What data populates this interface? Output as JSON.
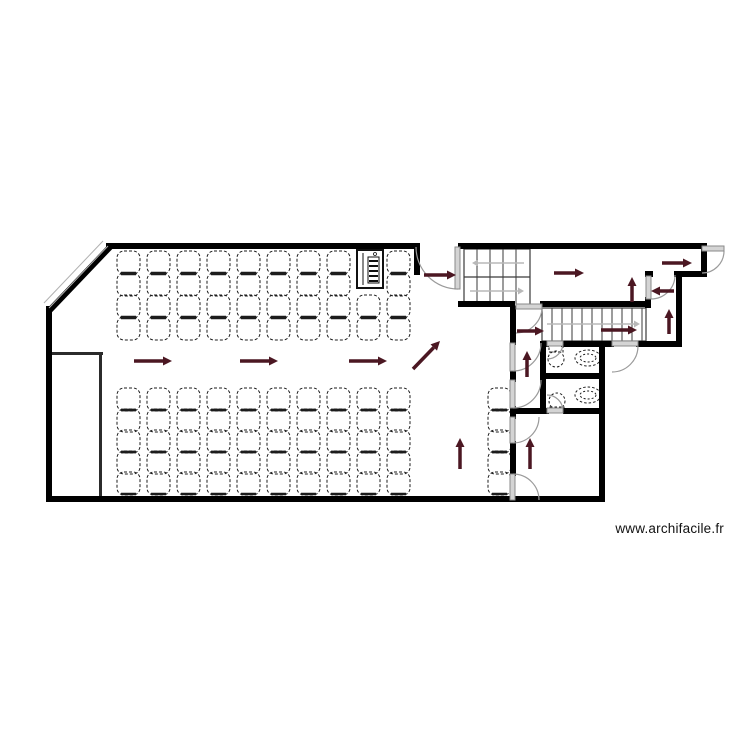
{
  "page": {
    "background": "#ffffff",
    "width": 750,
    "height": 750,
    "watermark": "www.archifacile.fr"
  },
  "colors": {
    "wall": "#000000",
    "inner_wall": "#2b2b2b",
    "arrow": "#4b1722",
    "door_leaf": "#d4d4d4",
    "door_leaf_stroke": "#8a8a8a",
    "door_arc": "#9a9a9a",
    "stair": "#3a3a3a",
    "stair_arrow": "#b8b8b8",
    "chair": "#1c1c1c",
    "fixture": "#1c1c1c",
    "window": "#b0b0b0",
    "panel": "#111111"
  },
  "plan": {
    "walls": [
      [
        106,
        243,
        313,
        6
      ],
      [
        458,
        243,
        249,
        6
      ],
      [
        701,
        243,
        6,
        34
      ],
      [
        674,
        271,
        33,
        6
      ],
      [
        645,
        271,
        8,
        6
      ],
      [
        645,
        297,
        6,
        11
      ],
      [
        676,
        271,
        6,
        76
      ],
      [
        601,
        341,
        13,
        6
      ],
      [
        636,
        341,
        46,
        6
      ],
      [
        599,
        341,
        6,
        161
      ],
      [
        46,
        496,
        559,
        6
      ],
      [
        46,
        306,
        6,
        196
      ],
      [
        414,
        243,
        6,
        32
      ],
      [
        458,
        301,
        57,
        6
      ],
      [
        540,
        301,
        110,
        6
      ],
      [
        510,
        306,
        6,
        39
      ],
      [
        510,
        371,
        6,
        11
      ],
      [
        510,
        406,
        6,
        13
      ],
      [
        510,
        441,
        6,
        35
      ],
      [
        540,
        341,
        6,
        73
      ],
      [
        540,
        341,
        9,
        6
      ],
      [
        561,
        341,
        42,
        6
      ],
      [
        540,
        373,
        63,
        6
      ],
      [
        510,
        408,
        39,
        6
      ],
      [
        563,
        408,
        40,
        6
      ]
    ],
    "inner_walls": [
      [
        46,
        352,
        57,
        3
      ],
      [
        99,
        352,
        3,
        147
      ]
    ],
    "diagonal_wall": {
      "x1": 48,
      "y1": 312,
      "x2": 111,
      "y2": 246,
      "w": 6
    },
    "window_lines": [
      [
        44,
        303,
        103,
        241
      ],
      [
        49,
        308,
        108,
        246
      ]
    ],
    "doors": [
      {
        "leaf": [
          455,
          247,
          5,
          42
        ],
        "arc": "M 458 289 A 42 42 0 0 1 416 247"
      },
      {
        "leaf": [
          702,
          246,
          22,
          5
        ],
        "arc": "M 724 251 A 22 22 0 0 1 702 273"
      },
      {
        "leaf": [
          646,
          276,
          5,
          23
        ],
        "arc": "M 651 299 A 24 24 0 0 0 675 275"
      },
      {
        "leaf": [
          516,
          304,
          26,
          5
        ],
        "arc": "M 542 307 A 26 26 0 0 1 516 333"
      },
      {
        "leaf": [
          510,
          343,
          5,
          28
        ],
        "arc": "M 513 371 A 28 28 0 0 0 541 343"
      },
      {
        "leaf": [
          510,
          380,
          5,
          28
        ],
        "arc": "M 513 408 A 28 28 0 0 0 541 380"
      },
      {
        "leaf": [
          510,
          417,
          5,
          26
        ],
        "arc": "M 539 417 A 26 26 0 0 1 513 443"
      },
      {
        "leaf": [
          510,
          474,
          5,
          26
        ],
        "arc": "M 513 474 A 26 26 0 0 1 539 500"
      },
      {
        "leaf": [
          547,
          341,
          16,
          5
        ],
        "arc": "M 563 343 A 16 16 0 0 1 547 359"
      },
      {
        "leaf": [
          547,
          408,
          16,
          5
        ],
        "arc": "M 563 411 A 16 16 0 0 0 547 395"
      },
      {
        "leaf": [
          612,
          341,
          26,
          5
        ],
        "arc": "M 638 346 A 26 26 0 0 1 612 372"
      }
    ],
    "evacuation_arrows": [
      [
        134,
        361,
        172,
        361
      ],
      [
        240,
        361,
        278,
        361
      ],
      [
        349,
        361,
        387,
        361
      ],
      [
        413,
        369,
        440,
        341
      ],
      [
        424,
        275,
        456,
        275
      ],
      [
        460,
        469,
        460,
        438
      ],
      [
        530,
        469,
        530,
        438
      ],
      [
        527,
        377,
        527,
        351
      ],
      [
        517,
        331,
        544,
        331
      ],
      [
        554,
        273,
        584,
        273
      ],
      [
        632,
        302,
        632,
        277
      ],
      [
        674,
        291,
        651,
        291
      ],
      [
        669,
        334,
        669,
        309
      ],
      [
        662,
        263,
        692,
        263
      ],
      [
        601,
        330,
        637,
        330
      ]
    ],
    "stairs": [
      {
        "kind": "u-shaped",
        "x": 464,
        "y": 249,
        "w": 66,
        "h": 57,
        "mid": 277,
        "treads_x": [
          477,
          490,
          503,
          516
        ],
        "run_arrows": [
          [
            524,
            263,
            472,
            263
          ],
          [
            470,
            291,
            524,
            291
          ]
        ]
      },
      {
        "kind": "straight",
        "x": 542,
        "y": 308,
        "w": 104,
        "h": 33,
        "treads_x": [
          552,
          562,
          572,
          582,
          592,
          602,
          612,
          622,
          632,
          642
        ],
        "run_arrows": [
          [
            547,
            324,
            640,
            324
          ]
        ]
      }
    ],
    "chair_blocks": [
      {
        "x0": 117,
        "y0": 251,
        "cols": 10,
        "rows": 4,
        "dx": 30,
        "dy": 22,
        "size": 23,
        "skip": [
          [
            8,
            0
          ],
          [
            8,
            1
          ]
        ]
      },
      {
        "x0": 117,
        "y0": 388,
        "cols": 10,
        "rows": 5,
        "dx": 30,
        "dy": 21,
        "size": 23,
        "skip": []
      },
      {
        "x0": 488,
        "y0": 388,
        "cols": 1,
        "rows": 5,
        "dx": 30,
        "dy": 21,
        "size": 23,
        "skip": []
      }
    ],
    "fixtures": [
      {
        "type": "toilet",
        "cx": 556,
        "cy": 359,
        "tank": [
          549,
          346,
          14,
          6
        ]
      },
      {
        "type": "sink",
        "cx": 588,
        "cy": 358
      },
      {
        "type": "sink",
        "cx": 588,
        "cy": 395
      },
      {
        "type": "toilet",
        "cx": 557,
        "cy": 401,
        "tank": [
          550,
          407,
          14,
          5
        ]
      }
    ],
    "electrical_panel": {
      "x": 357,
      "y": 250,
      "w": 26,
      "h": 38
    }
  }
}
